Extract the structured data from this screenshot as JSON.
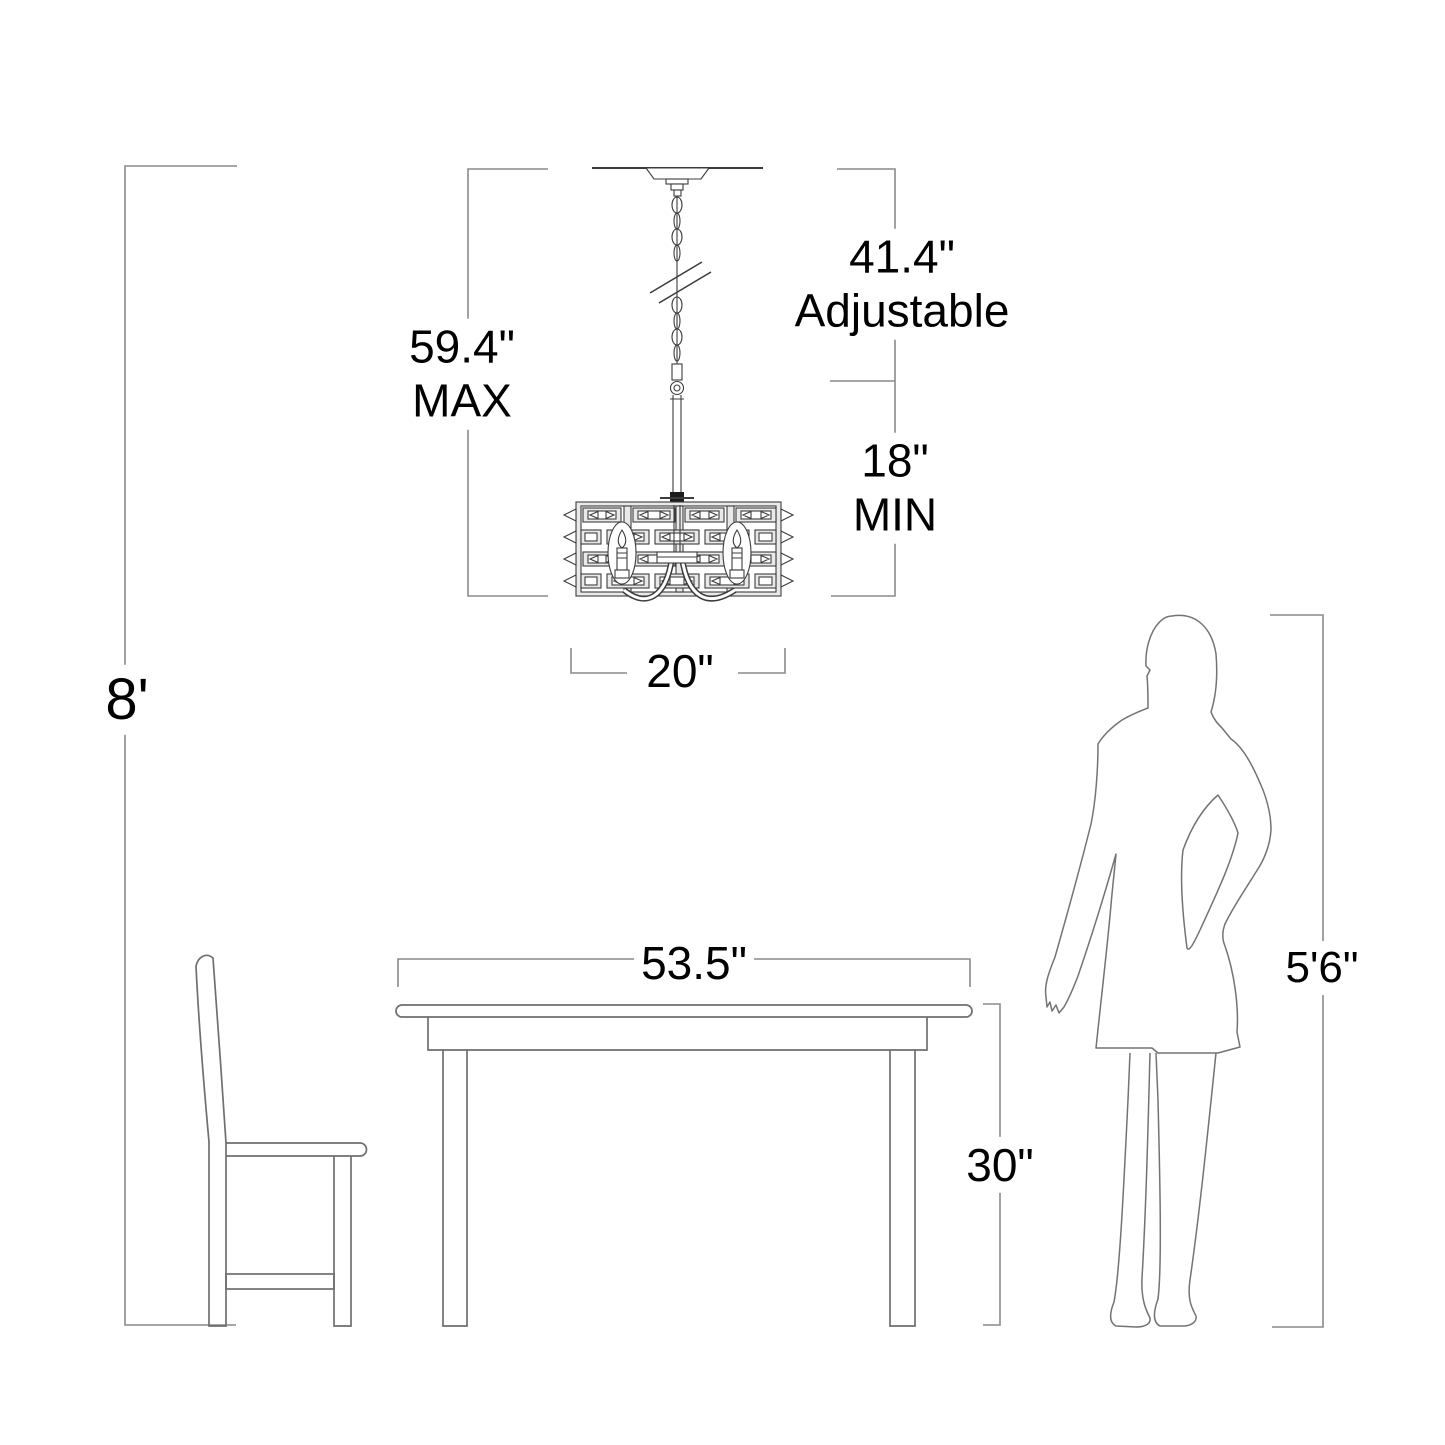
{
  "diagram": {
    "type": "lighting-fixture-dimension-drawing",
    "labels": {
      "max_value": "59.4\"",
      "max_caption": "MAX",
      "adjustable_value": "41.4\"",
      "adjustable_caption": "Adjustable",
      "min_value": "18\"",
      "min_caption": "MIN",
      "fixture_width": "20\"",
      "ceiling_height": "8'",
      "table_width": "53.5\"",
      "table_height": "30\"",
      "person_height": "5'6\""
    },
    "figures": [
      "chandelier with chain",
      "dining table",
      "side chair",
      "standing woman silhouette"
    ]
  },
  "colors": {
    "text": "#000000",
    "dimension_line": "#8a8a8a",
    "furniture_line": "#6f6f6f",
    "person_line": "#737373",
    "fixture_line": "#3c3c3c",
    "bg": "#ffffff"
  }
}
